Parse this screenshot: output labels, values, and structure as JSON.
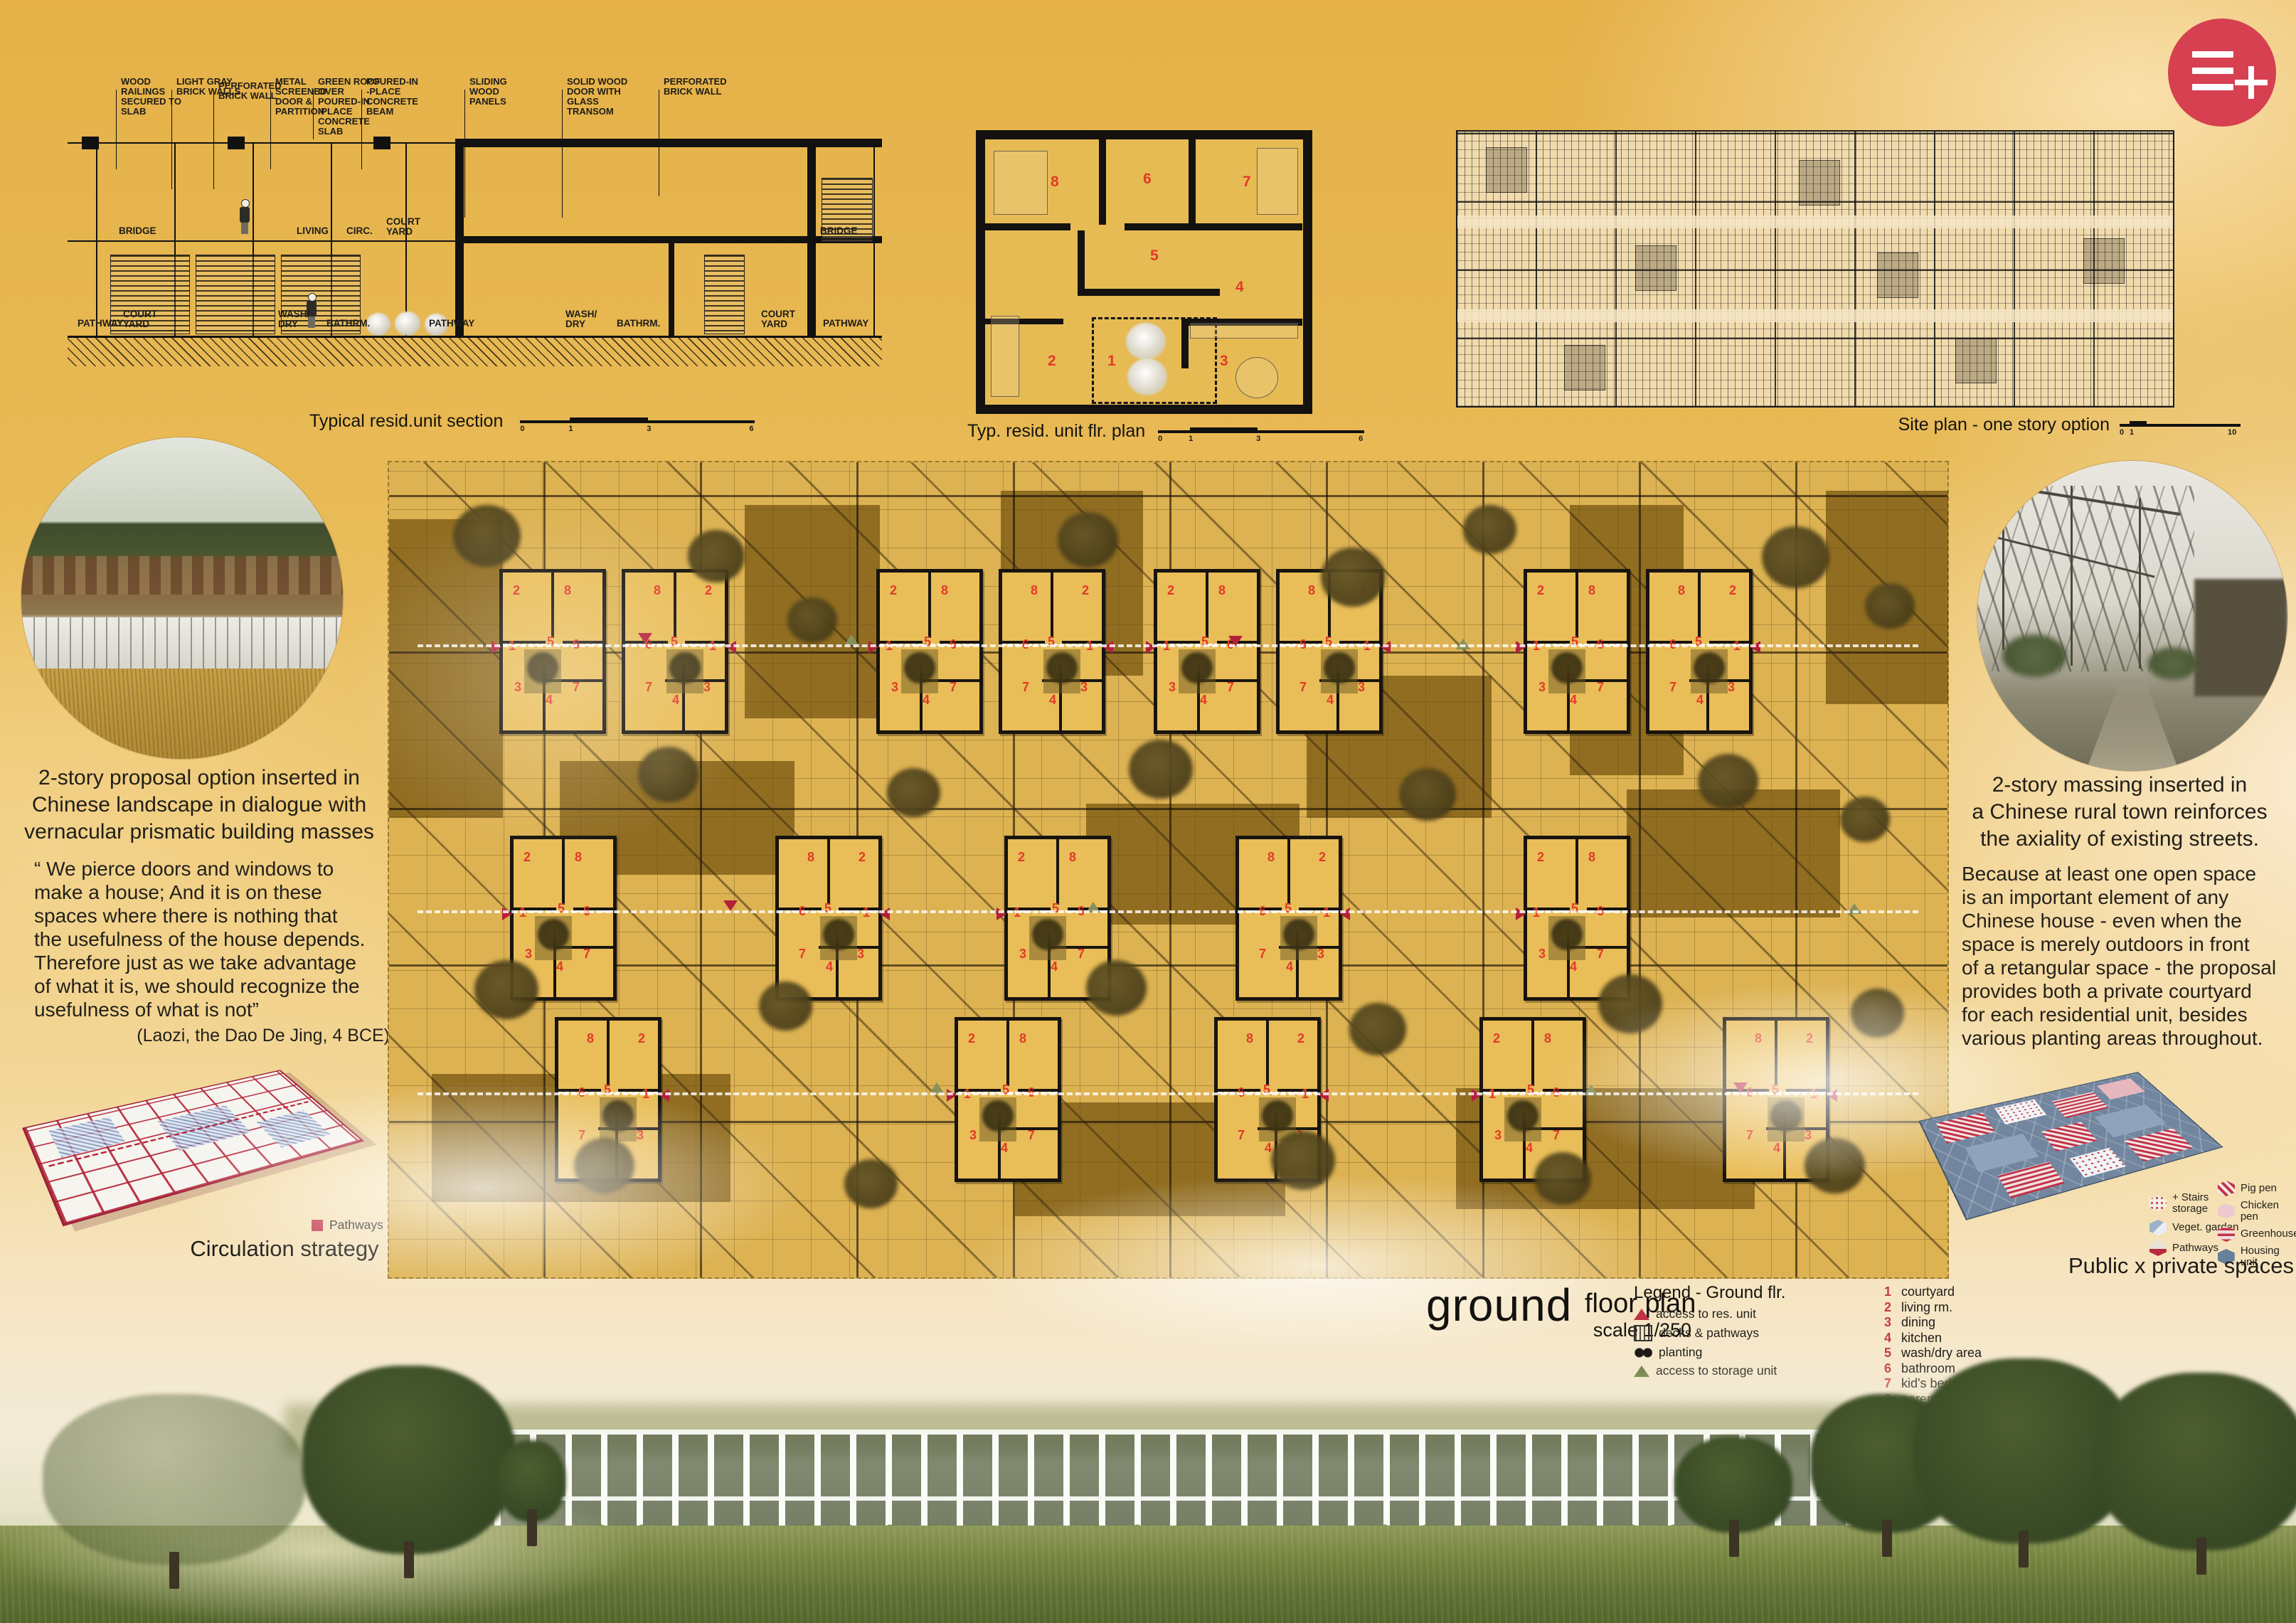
{
  "logo_icon": "three-lines-plus-icon",
  "section": {
    "caption": "Typical resid.unit section",
    "scale_ticks": [
      "0",
      "1",
      "3",
      "6"
    ],
    "callouts": [
      "WOOD\nRAILINGS\nSECURED TO\nSLAB",
      "LIGHT GRAY\nBRICK WALLS",
      "PERFORATED\nBRICK WALL",
      "METAL\nSCREENED\nDOOR &\nPARTITION",
      "GREEN ROOF\nOVER\nPOURED-IN\n-PLACE\nCONCRETE\nSLAB",
      "POURED-IN\n-PLACE\nCONCRETE\nBEAM",
      "SLIDING WOOD\nPANELS",
      "SOLID WOOD\nDOOR WITH\nGLASS TRANSOM",
      "PERFORATED\nBRICK WALL"
    ],
    "upper_rooms": [
      "BRIDGE",
      "LIVING",
      "CIRC.",
      "COURT\nYARD",
      "BRIDGE"
    ],
    "lower_rooms": [
      "PATHWAY",
      "COURT\nYARD",
      "WASH/\nDRY",
      "BATHRM.",
      "PATHWAY",
      "WASH/\nDRY",
      "BATHRM.",
      "COURT\nYARD",
      "PATHWAY"
    ]
  },
  "unit_plan": {
    "caption": "Typ. resid. unit flr. plan",
    "scale_ticks": [
      "0",
      "1",
      "3",
      "6"
    ],
    "numbers": [
      "1",
      "2",
      "3",
      "4",
      "5",
      "6",
      "7",
      "8"
    ]
  },
  "site_plan": {
    "caption": "Site plan  - one story option",
    "scale_ticks": [
      "0",
      "1",
      "10"
    ]
  },
  "left_column": {
    "photo_icon": "rural-landscape-photo",
    "caption": "2-story proposal option inserted in\nChinese landscape in dialogue with\nvernacular prismatic building masses",
    "quote": "“ We pierce doors and windows to\nmake a house; And it is on these\nspaces where there is nothing that\nthe usefulness of the house depends.\nTherefore just as we take advantage\nof what it is, we should recognize the\nusefulness of what is not”",
    "attribution": "(Laozi, the Dao De Jing, 4 BCE)",
    "circulation": {
      "legend_label": "Pathways",
      "caption": "Circulation strategy"
    }
  },
  "right_column": {
    "photo_icon": "greenhouse-street-photo",
    "caption": "2-story massing inserted in\na Chinese rural town reinforces\nthe axiality of existing streets.",
    "paragraph": "Because at least one open space\nis an important element of any\nChinese house - even when the\nspace is merely outdoors in front\nof a retangular space - the proposal\nprovides both a private courtyard\nfor each residential unit, besides\nvarious planting areas throughout.",
    "public_private": {
      "caption": "Public x private spaces",
      "legend_left": [
        "+ Stairs\nstorage",
        "Veget. garden",
        "Pathways"
      ],
      "legend_right": [
        "Pig pen",
        "Chicken pen",
        "Greenhouse",
        "Housing unit"
      ]
    }
  },
  "ground_plan": {
    "title_big": "ground",
    "title_rest": "floor plan",
    "scale": "scale 1/250",
    "legend_title": "Legend - Ground flr.",
    "legend_items": [
      {
        "icon": "red-triangle-icon",
        "label": "access to res. unit"
      },
      {
        "icon": "hatched-square-icon",
        "label": "decks & pathways"
      },
      {
        "icon": "planting-dots-icon",
        "label": "planting"
      },
      {
        "icon": "green-triangle-icon",
        "label": "access to storage unit"
      }
    ],
    "room_list": [
      {
        "n": "1",
        "label": "courtyard"
      },
      {
        "n": "2",
        "label": "living rm."
      },
      {
        "n": "3",
        "label": "dining"
      },
      {
        "n": "4",
        "label": "kitchen"
      },
      {
        "n": "5",
        "label": "wash/dry area"
      },
      {
        "n": "6",
        "label": "bathroom"
      },
      {
        "n": "7",
        "label": "kid's bedrm."
      },
      {
        "n": "8",
        "label": "parents bedrm."
      }
    ],
    "cluster_numbers": [
      "2",
      "8",
      "1",
      "5",
      "6",
      "3",
      "4",
      "7"
    ]
  },
  "colors": {
    "accent_red": "#c23246",
    "board_gold": "#e6b84f",
    "plan_olive": "#8a7a33",
    "housing_blue": "#72869f"
  }
}
